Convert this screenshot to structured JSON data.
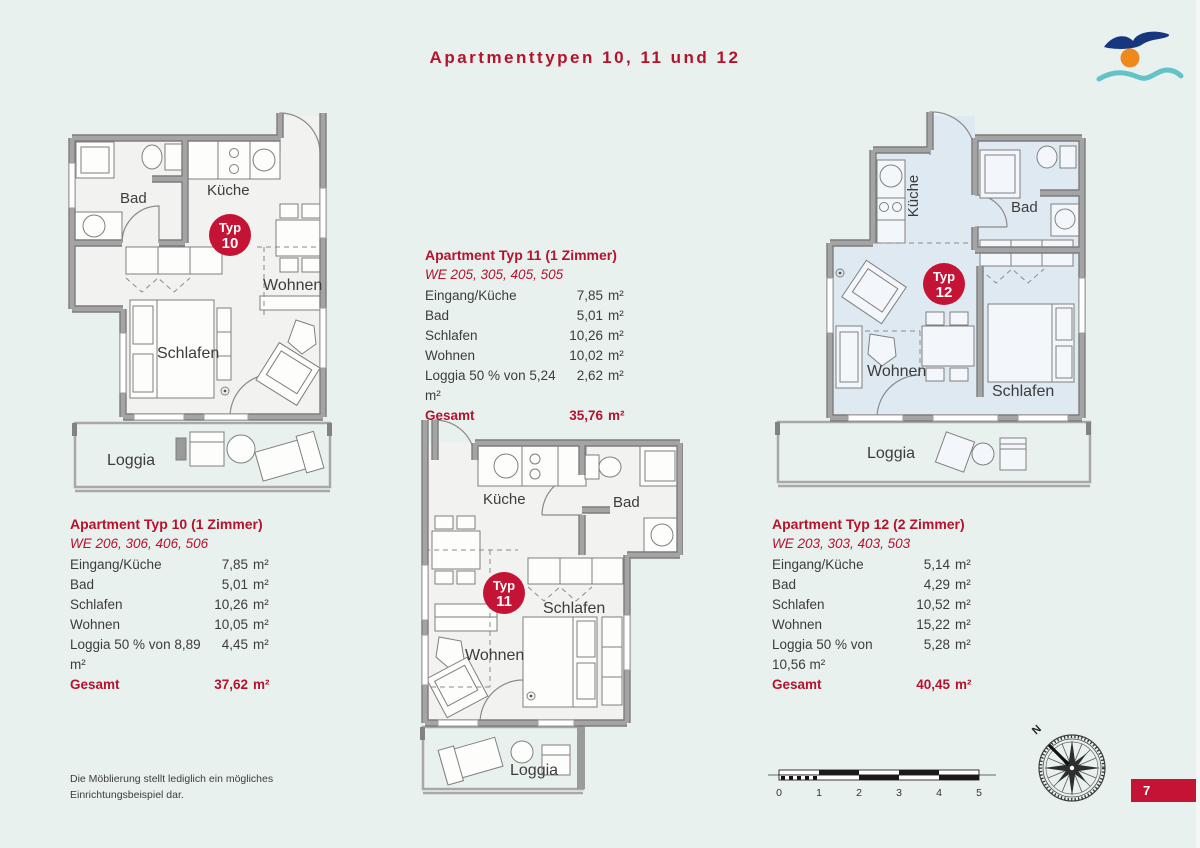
{
  "page": {
    "title": "Apartmenttypen 10, 11 und 12",
    "page_number": "7",
    "disclaimer_line1": "Die Möblierung stellt lediglich ein mögliches",
    "disclaimer_line2": "Einrichtungsbeispiel dar.",
    "compass_label": "N"
  },
  "colors": {
    "background": "#e9f1ef",
    "accent_red": "#b5122c",
    "badge_red": "#c41334",
    "wall_gray": "#9b9b9b",
    "plan_fill": "#f2f2f0",
    "plan_fill_blue": "#dfe9f2",
    "logo_blue": "#16367f",
    "logo_orange": "#ee8a1c",
    "logo_teal": "#63c3c6"
  },
  "scale_bar": {
    "labels": [
      "0",
      "1",
      "2",
      "3",
      "4",
      "5"
    ]
  },
  "apartments": [
    {
      "id": "typ10",
      "badge": {
        "word": "Typ",
        "number": "10"
      },
      "rooms": {
        "bad": "Bad",
        "kueche": "Küche",
        "wohnen": "Wohnen",
        "schlafen": "Schlafen",
        "loggia": "Loggia"
      },
      "table": {
        "heading": "Apartment Typ 10 (1 Zimmer)",
        "we": "WE 206, 306, 406, 506",
        "rows": [
          {
            "label": "Eingang/Küche",
            "value": "7,85",
            "unit": "m²"
          },
          {
            "label": "Bad",
            "value": "5,01",
            "unit": "m²"
          },
          {
            "label": "Schlafen",
            "value": "10,26",
            "unit": "m²"
          },
          {
            "label": "Wohnen",
            "value": "10,05",
            "unit": "m²"
          },
          {
            "label": "Loggia 50 % von 8,89 m²",
            "value": "4,45",
            "unit": "m²"
          }
        ],
        "total": {
          "label": "Gesamt",
          "value": "37,62",
          "unit": "m²"
        }
      }
    },
    {
      "id": "typ11",
      "badge": {
        "word": "Typ",
        "number": "11"
      },
      "rooms": {
        "bad": "Bad",
        "kueche": "Küche",
        "wohnen": "Wohnen",
        "schlafen": "Schlafen",
        "loggia": "Loggia"
      },
      "table": {
        "heading": "Apartment Typ 11 (1 Zimmer)",
        "we": "WE 205, 305, 405, 505",
        "rows": [
          {
            "label": "Eingang/Küche",
            "value": "7,85",
            "unit": "m²"
          },
          {
            "label": "Bad",
            "value": "5,01",
            "unit": "m²"
          },
          {
            "label": "Schlafen",
            "value": "10,26",
            "unit": "m²"
          },
          {
            "label": "Wohnen",
            "value": "10,02",
            "unit": "m²"
          },
          {
            "label": "Loggia 50 % von 5,24 m²",
            "value": "2,62",
            "unit": "m²"
          }
        ],
        "total": {
          "label": "Gesamt",
          "value": "35,76",
          "unit": "m²"
        }
      }
    },
    {
      "id": "typ12",
      "badge": {
        "word": "Typ",
        "number": "12"
      },
      "rooms": {
        "bad": "Bad",
        "kueche": "Küche",
        "wohnen": "Wohnen",
        "schlafen": "Schlafen",
        "loggia": "Loggia"
      },
      "table": {
        "heading": "Apartment Typ 12 (2 Zimmer)",
        "we": "WE 203, 303, 403, 503",
        "rows": [
          {
            "label": "Eingang/Küche",
            "value": "5,14",
            "unit": "m²"
          },
          {
            "label": "Bad",
            "value": "4,29",
            "unit": "m²"
          },
          {
            "label": "Schlafen",
            "value": "10,52",
            "unit": "m²"
          },
          {
            "label": "Wohnen",
            "value": "15,22",
            "unit": "m²"
          },
          {
            "label": "Loggia 50 % von 10,56 m²",
            "value": "5,28",
            "unit": "m²"
          }
        ],
        "total": {
          "label": "Gesamt",
          "value": "40,45",
          "unit": "m²"
        }
      }
    }
  ]
}
